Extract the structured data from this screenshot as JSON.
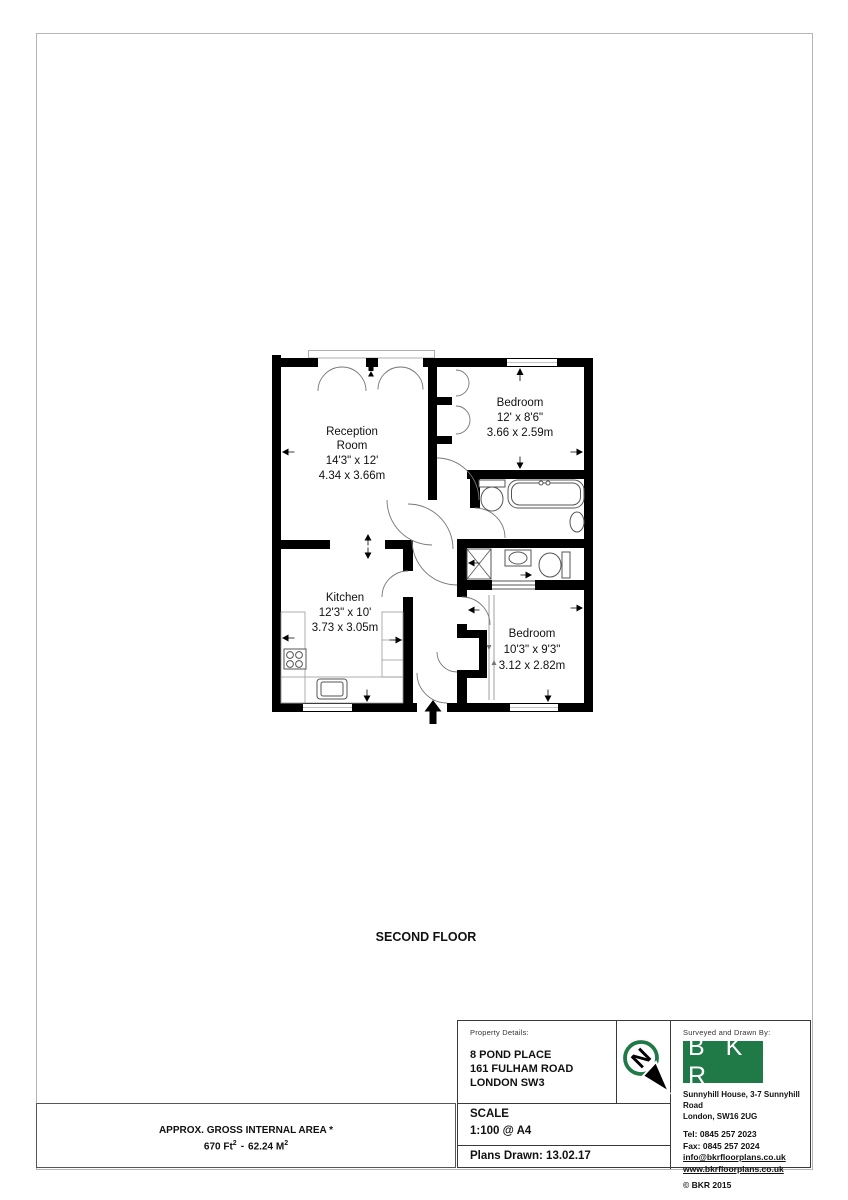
{
  "colors": {
    "accent_green": "#1f7a47",
    "wall_black": "#000000"
  },
  "plan": {
    "floor_label": "SECOND FLOOR",
    "compass_letter": "N",
    "rooms": [
      {
        "lines": [
          "Reception",
          "Room",
          "14'3\" x 12'",
          "4.34 x 3.66m"
        ]
      },
      {
        "lines": [
          "Bedroom",
          "12' x 8'6\"",
          "3.66 x 2.59m"
        ]
      },
      {
        "lines": [
          "Kitchen",
          "12'3\" x 10'",
          "3.73 x 3.05m"
        ]
      },
      {
        "lines": [
          "Bedroom",
          "10'3\" x 9'3\"",
          "3.12 x 2.82m"
        ]
      }
    ]
  },
  "area_note": {
    "line1": "APPROX. GROSS INTERNAL  AREA *",
    "imperial": "670 Ft",
    "metric": "62.24 M",
    "sup": "2",
    "separator": "-"
  },
  "title_block": {
    "property_details_label": "Property Details:",
    "address": [
      "8 POND PLACE",
      "161 FULHAM ROAD",
      "LONDON SW3"
    ],
    "scale_label": "SCALE",
    "scale_value": "1:100 @ A4",
    "plans_drawn": "Plans Drawn: 13.02.17",
    "surveyed_label": "Surveyed and Drawn By:",
    "logo_text": "B K R",
    "company_address": [
      "Sunnyhill House, 3-7 Sunnyhill Road",
      "London, SW16 2UG"
    ],
    "tel": "Tel:  0845 257 2023",
    "fax": "Fax: 0845 257 2024",
    "email": "info@bkrfloorplans.co.uk",
    "website": "www.bkrfloorplans.co.uk",
    "copyright_symbol": "©",
    "copyright": "BKR 2015"
  }
}
